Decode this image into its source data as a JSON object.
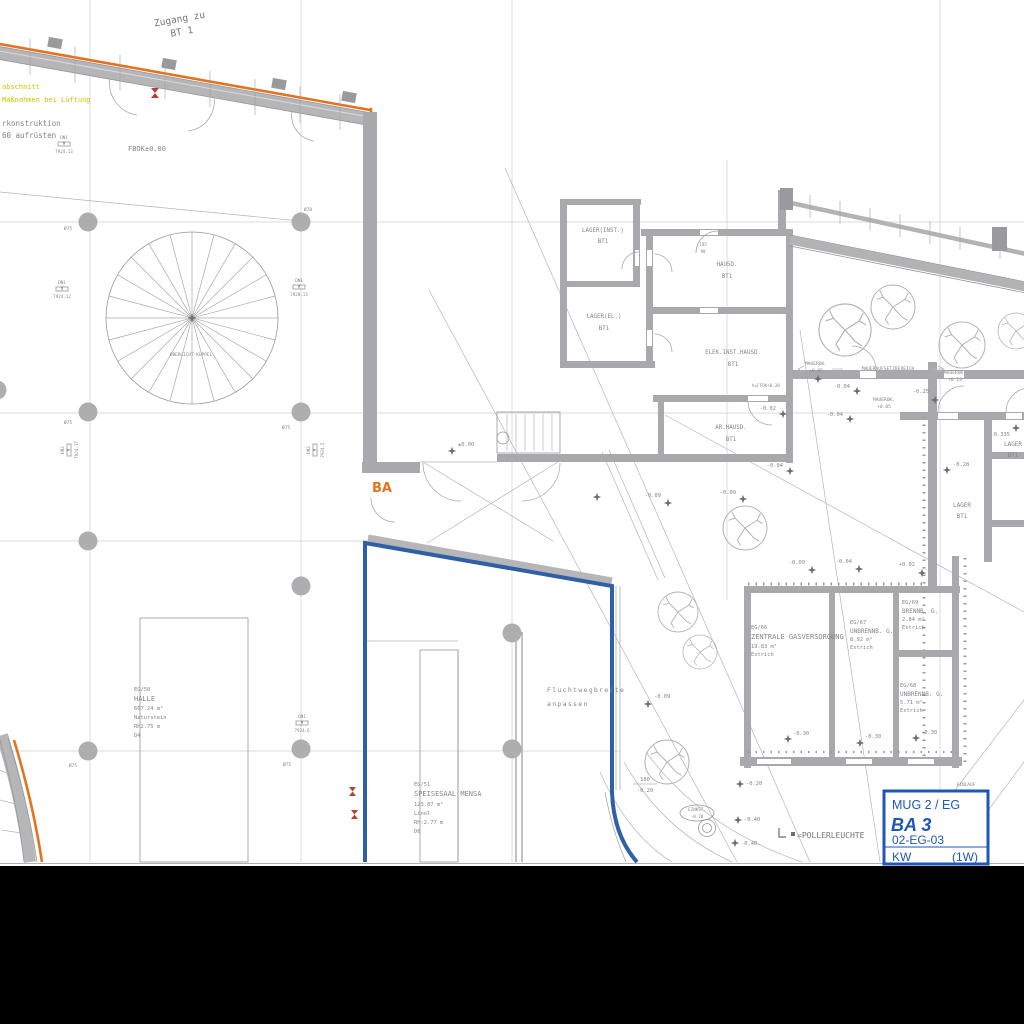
{
  "colors": {
    "boundary_orange": "#e4731f",
    "boundary_blue": "#2f5fa5",
    "note_yellow": "#cfc400",
    "title_blue": "#1d57b8",
    "wall_gray": "#a9a9ad"
  },
  "notes": {
    "zugang_1": "Zugang zu",
    "zugang_2": "BT 1",
    "fire_1": "abschnitt",
    "fire_2": "Maßnahmen bei Lüftung",
    "constr_1": "rkonstruktion",
    "constr_2": "60 aufrüsten",
    "fbok": "FBOK±0.00",
    "skylight": "OBERLICHT-KUPPEL",
    "ba": "BA",
    "escape_1": "Fluchtwegbreite",
    "escape_2": "anpassen",
    "legend_symbol": "L",
    "legend_poller": "=POLLERLEUCHTE",
    "einlauf": "EINLAUF",
    "einkst_1": "EINKST.",
    "einkst_2": "-0.70",
    "dim_180": "180",
    "dim_020": "-0.20",
    "door_dim_1": "195",
    "door_dim_2": "90",
    "h_ffok": "h=FFOK+0.20"
  },
  "wall_notes": {
    "m1_1": "MAUEROK.",
    "m1_2": "+0.05",
    "bereich": "MAUERAUFSETZBEREICH",
    "m2_1": "MAUEROK.",
    "m2_2": "+0.13",
    "m3_1": "MAUEROK.",
    "m3_2": "+0.05"
  },
  "rooms": {
    "lager_inst": {
      "lines": [
        "LAGER(INST.)",
        "BT1"
      ]
    },
    "hausd": {
      "lines": [
        "HAUSD.",
        "BT1"
      ]
    },
    "lager_el": {
      "lines": [
        "LAGER(EL.)",
        "BT1"
      ]
    },
    "elek_inst": {
      "lines": [
        "ELEK.INST.HAUSD.",
        "BT1"
      ]
    },
    "ar_hausd": {
      "lines": [
        "AR.HAUSD.",
        "BT1"
      ]
    },
    "lager_r1": {
      "lines": [
        "LAGER",
        "BT1"
      ]
    },
    "lager_r2": {
      "lines": [
        "LAGER",
        "BT1"
      ]
    },
    "eg50": {
      "lines": [
        "EG/50",
        "HALLE",
        "667.24 m²",
        "Naturstein",
        "RH2.75 m",
        "D4"
      ]
    },
    "eg51": {
      "lines": [
        "EG/51",
        "SPEISESAAL MENSA",
        "123.87 m²",
        "Linol",
        "RH:2.77 m",
        "D6"
      ]
    },
    "eg66": {
      "lines": [
        "EG/66",
        "ZENTRALE GASVERSORGUNG",
        "19.83 m²",
        "Estrich"
      ]
    },
    "eg67": {
      "lines": [
        "EG/67",
        "UNBRENNB. G.",
        "8.92 m²",
        "Estrich"
      ]
    },
    "eg69": {
      "lines": [
        "EG/69",
        "BRENNB. G.",
        "2.84 m²",
        "Estrich"
      ]
    },
    "eg68": {
      "lines": [
        "EG/68",
        "UNBRENNB. G.",
        "5.71 m²",
        "Estrich"
      ]
    }
  },
  "elevations": [
    "±0.00",
    "-0.02",
    "-0.04",
    "-0.04",
    "-0.25",
    "-0.04",
    "-0.09",
    "-0.09",
    "-0.09",
    "-0.04",
    "+0.02",
    "-0.28",
    "-0.335",
    "-0.09",
    "-0.30",
    "-0.30",
    "-0.30",
    "-0.20",
    "-0.40",
    "-0.40"
  ],
  "datums": [
    {
      "name": "DN1",
      "value": "7924.13"
    },
    {
      "name": "DN1",
      "value": "7924.12"
    },
    {
      "name": "DN1",
      "value": "7928.13"
    },
    {
      "name": "DN2",
      "value": "7924.17"
    },
    {
      "name": "DN2",
      "value": "7924.5"
    },
    {
      "name": "DN1",
      "value": "7924.6"
    }
  ],
  "column_labels": [
    "Ø75",
    "Ø70",
    "Ø75",
    "Ø75",
    "Ø75",
    "Ø75"
  ],
  "title_block": {
    "line1": "MUG 2 / EG",
    "line2": "BA 3",
    "line3": "02-EG-03",
    "line4_left": "KW",
    "line4_right": "(1W)"
  }
}
